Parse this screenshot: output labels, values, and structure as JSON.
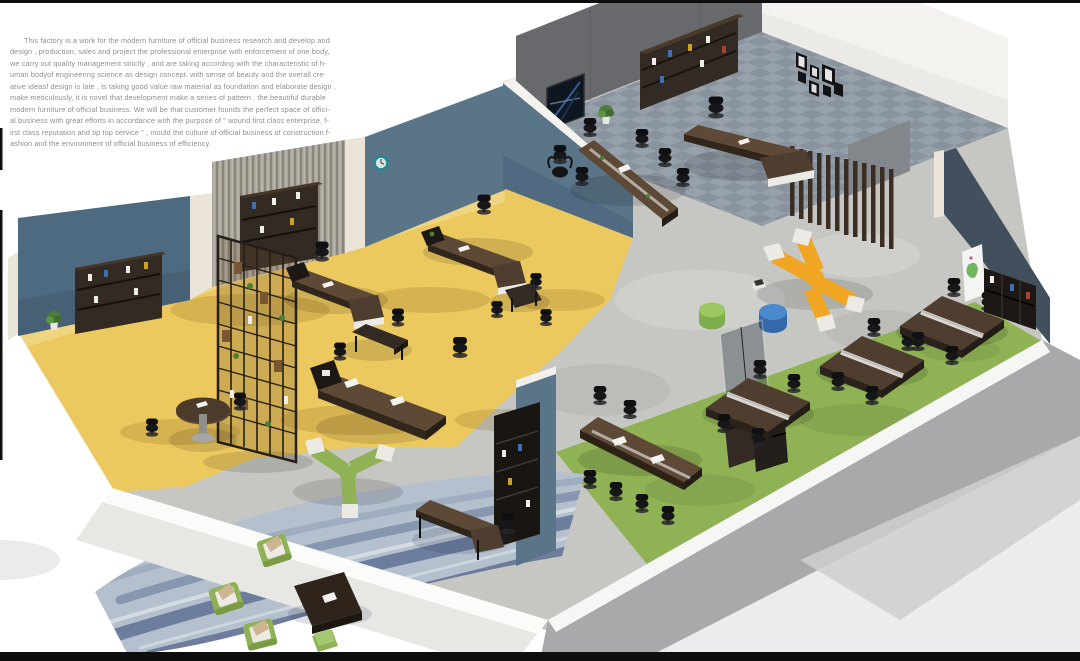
{
  "description": {
    "lines": [
      "This factory is a work for the modern furniture of official business research and develop and",
      "design , production, sales and project the professional enterprise with enforcement of one body,",
      "we carry out quality management strictly , and are taking according with the characteristic of h-",
      "uman bodyof engineering science as design concept, with sense of beauty and the overall cre-",
      "ative ideasf design is late , is taking good value raw material as foundation and elaborate design ,",
      "make meticulously, it is novel that development make a series of pattern , the beautiful durable",
      "modern furniture of official business. We will be that customer founds the perfect space of offici-",
      "al business with great efforts in accordance with the purpose of \" wound first class enterprise, f-",
      "irst class reputation and tip top service \" , mould the culture of official business of construction f-",
      "ashion and the environment of official business of efficiency."
    ]
  },
  "scene": {
    "label": "isometric 3D render of a modern office furniture showroom floor plan",
    "areas": [
      {
        "id": "open-office-yellow",
        "floor": "yellow carpet"
      },
      {
        "id": "executive-office",
        "floor": "gray tile"
      },
      {
        "id": "corridor-lounge",
        "floor": "bare concrete"
      },
      {
        "id": "workstation-zone",
        "floor": "green carpet"
      },
      {
        "id": "reading-lounge",
        "floor": "blue water-pattern rug"
      }
    ],
    "objects": [
      "blue feature wall",
      "textured slat wall",
      "wall clock",
      "bull-head trophy",
      "open steel bookshelf divider",
      "wall bookshelves",
      "executive L-desks",
      "round meeting table",
      "square meeting table",
      "triangle meeting table",
      "conference tables",
      "office chairs",
      "wood slat screen",
      "photo frame gallery",
      "abstract wall art",
      "potted plants",
      "yellow modular X-sofa",
      "green modular Y-sofa",
      "green ottoman",
      "blue ottoman",
      "magazine pile",
      "workstation clusters",
      "glass partition",
      "storage cabinets",
      "poster",
      "media wall cabinet",
      "writing desk",
      "coffee table",
      "green armchairs with pillows",
      "green stool"
    ],
    "palette": {
      "page_bg": "#ffffff",
      "text_gray": "#8e8e8e",
      "frame_black": "#0e0e0e",
      "floor_yellow": "#ecc95e",
      "floor_yellow_shadow": "#8a6420",
      "floor_tile": "#97a1ab",
      "floor_tile_dark": "#87919c",
      "floor_concrete": "#c6c6c3",
      "floor_green": "#8fb254",
      "floor_green_dark": "#6d9040",
      "carpet_base": "#b4c0cd",
      "carpet_dark": "#54678c",
      "carpet_mid": "#7286a3",
      "wall_blue": "#4e6a80",
      "wall_blue_light": "#5b7588",
      "wall_cream": "#eae5d8",
      "wall_texture": "#a8a49a",
      "wall_texture_dark": "#6f6b60",
      "wall_dark": "#67696c",
      "wall_mid": "#83868a",
      "wall_white": "#f3f2ef",
      "wall_navy": "#42505e",
      "wall_outer": "#a9a9ab",
      "wall_outer_light": "#cfcfd1",
      "wood_dark": "#322a23",
      "wood_brown": "#4f3e2f",
      "wood_top": "#5d4936",
      "chair_black": "#17171a",
      "sofa_yellow": "#f0a622",
      "sofa_green": "#8fb254",
      "ottoman_green_top": "#9cc763",
      "ottoman_green": "#7fae4c",
      "ottoman_blue_top": "#4b89cd",
      "ottoman_blue": "#3468a8",
      "cushion_white": "#eceae4",
      "pillow_tan": "#cdb492",
      "plant_green": "#4e7d3a",
      "accent_teal": "#1f8a94"
    }
  }
}
